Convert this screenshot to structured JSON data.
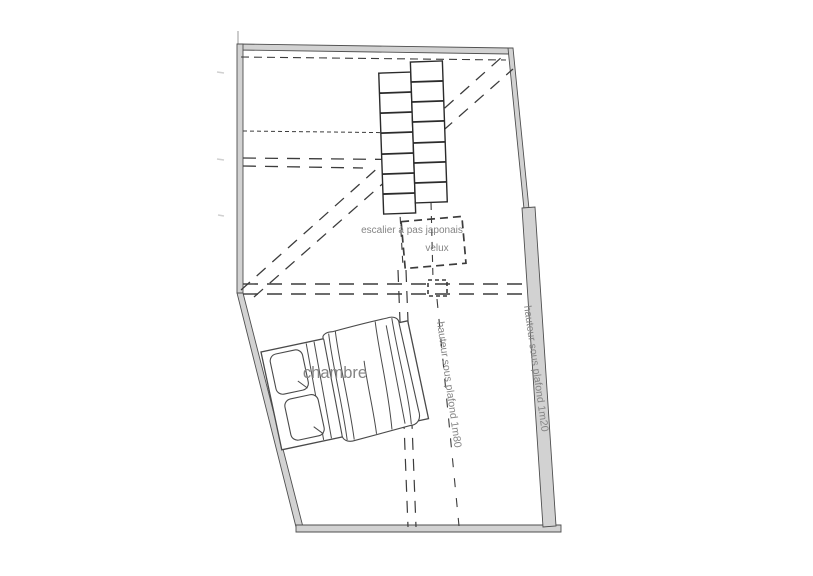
{
  "plan": {
    "labels": {
      "room": "chambre",
      "stair": "escalier à pas japonais",
      "roof_window": "velux",
      "ceiling_height_1m80": "hauteur sous plafond 1m80",
      "ceiling_height_1m20": "hauteur sous plafond 1m20"
    },
    "colors": {
      "background": "#ffffff",
      "wall_fill": "#d2d2d2",
      "wall_edge": "#4f4f4f",
      "line": "#3c3c3c",
      "text": "#858585"
    }
  }
}
